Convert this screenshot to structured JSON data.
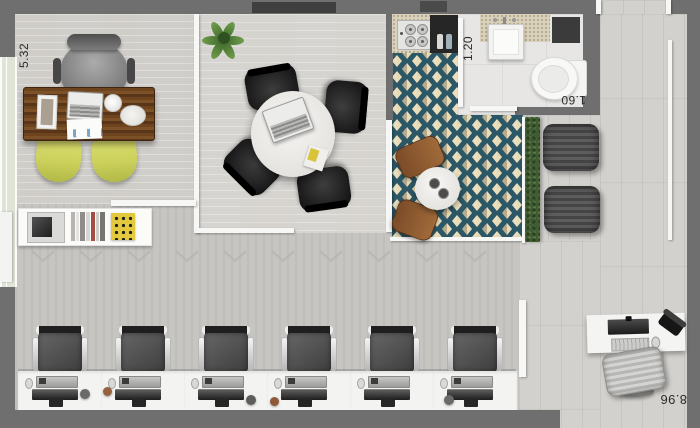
{
  "labels": {
    "dim_office_depth": "5.32",
    "dim_bathroom_width": "1.20",
    "dim_bathroom_length": "1.60",
    "dim_plan_width": "8.96"
  },
  "workspace": {
    "workstation_count": 6
  },
  "colors": {
    "outer_wall": "#6f6f6f",
    "floor_wood": "#d7d5d1",
    "floor_open": "#c7c5c1",
    "floor_terrace": "#d3d1cd",
    "tile_teal": "#2c5766",
    "tile_cream": "#e8dcb8",
    "chair_yellow": "#ccd15c",
    "hedge_green": "#3f5c33",
    "desk_wood": "#6e441f",
    "lounge_gray": "#454545"
  }
}
